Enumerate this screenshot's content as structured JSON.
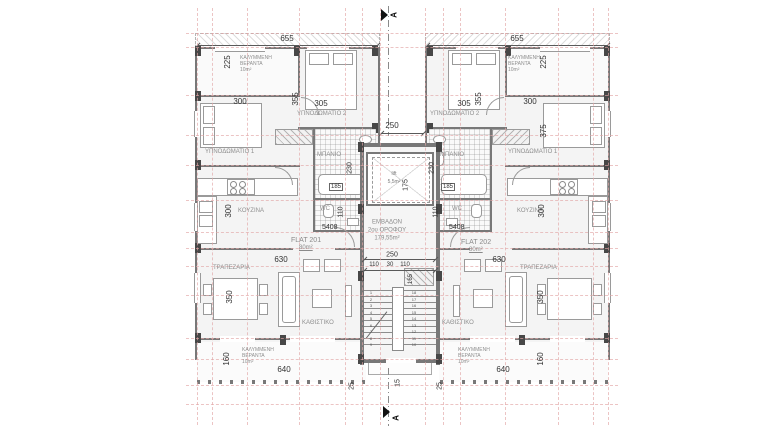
{
  "colors": {
    "grid": "#e2a6a6",
    "wall": "#787878",
    "pier": "#474747"
  },
  "section": {
    "top": "A",
    "bottom": "A"
  },
  "core": {
    "dim_gap_top": "250",
    "lift": {
      "label": "lift",
      "area": "5,5m²",
      "dim": "175"
    },
    "area_note": {
      "line1": "ΕΜΒΑΔΟΝ",
      "line2": "2ου ΟΡΟΦΟΥ",
      "line3": "179,55m²"
    },
    "dim_hall_total": "250",
    "dim_hall_left": "110",
    "dim_hall_mid": "30",
    "dim_hall_right": "110",
    "dim_stair_side": "165",
    "dim_exit": "15",
    "stair_numbers_left": [
      "1",
      "2",
      "3",
      "4",
      "5",
      "6",
      "7",
      "8",
      "9"
    ],
    "stair_numbers_right": [
      "18",
      "17",
      "16",
      "15",
      "14",
      "13",
      "12",
      "11",
      "10"
    ]
  },
  "flat_left": {
    "flat_name": "FLAT 201",
    "flat_area": "80m²",
    "door_tag": "5408",
    "dim_width": "655",
    "dim_corner": "25",
    "veranda_top": {
      "l1": "ΚΑΛΥΜΜΕΝΗ",
      "l2": "ΒΕΡΑΝΤΑ",
      "area": "10m²",
      "dim": "225"
    },
    "bedroom1": {
      "name": "ΥΠΝΟΔΩΜΑΤΙΟ 1",
      "dim_w": "300"
    },
    "bedroom2": {
      "name": "ΥΠΝΟΔΩΜΑΤΙΟ 2",
      "dim_w": "305",
      "dim_h": "355"
    },
    "bath": {
      "name": "ΜΠΑΝΙΟ",
      "dim_w": "185",
      "dim_h": "230"
    },
    "wc": {
      "name": "WC",
      "dim": "110"
    },
    "kitchen": {
      "name": "ΚΟΥΖΙΝΑ",
      "dim": "300"
    },
    "living_dim": "630",
    "dining": {
      "name": "ΤΡΑΠΕΖΑΡΙΑ",
      "dim_table": "350"
    },
    "living": {
      "name": "ΚΑΘΙΣΤΙΚΟ"
    },
    "veranda_bottom": {
      "l1": "ΚΑΛΥΜΜΕΝΗ",
      "l2": "ΒΕΡΑΝΤΑ",
      "area": "10m²",
      "dim_h": "160",
      "dim_w": "640"
    }
  },
  "flat_right": {
    "flat_name": "FLAT 202",
    "flat_area": "80m²",
    "door_tag": "5408",
    "dim_width": "655",
    "dim_corner": "25",
    "veranda_top": {
      "l1": "ΚΑΛΥΜΜΕΝΗ",
      "l2": "ΒΕΡΑΝΤΑ",
      "area": "10m²",
      "dim": "225"
    },
    "bedroom1": {
      "name": "ΥΠΝΟΔΩΜΑΤΙΟ 1",
      "dim_w": "300",
      "dim_h": "375"
    },
    "bedroom2": {
      "name": "ΥΠΝΟΔΩΜΑΤΙΟ 2",
      "dim_w": "305",
      "dim_h": "355"
    },
    "bath": {
      "name": "ΜΠΑΝΙΟ",
      "dim_w": "185",
      "dim_h": "230"
    },
    "wc": {
      "name": "WC",
      "dim": "110"
    },
    "kitchen": {
      "name": "ΚΟΥΖΙΝΑ",
      "dim": "300"
    },
    "living_dim": "630",
    "dining": {
      "name": "ΤΡΑΠΕΖΑΡΙΑ",
      "dim_table": "350"
    },
    "living": {
      "name": "ΚΑΘΙΣΤΙΚΟ"
    },
    "veranda_bottom": {
      "l1": "ΚΑΛΥΜΜΕΝΗ",
      "l2": "ΒΕΡΑΝΤΑ",
      "area": "10m²",
      "dim_h": "160",
      "dim_w": "640"
    }
  }
}
